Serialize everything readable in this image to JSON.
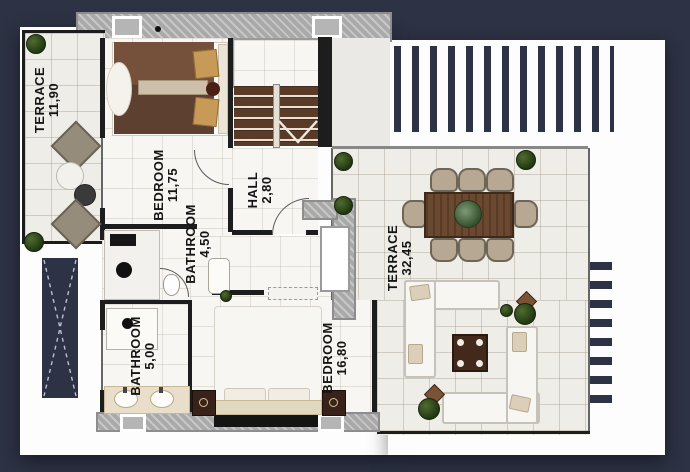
{
  "plan_title": "villa-upper-floor-plan",
  "palette": {
    "background": "#2d3244",
    "paper": "#fdfdfd",
    "wall_dark": "#1d1d1d",
    "wall_gray": "#a9a9a9",
    "stair_wood": "#5a3b28",
    "bed_wood": "#6d4a34",
    "plant_green": "#2f4a1b"
  },
  "rooms": [
    {
      "name": "TERRACE",
      "area": "11,90"
    },
    {
      "name": "BEDROOM",
      "area": "11,75"
    },
    {
      "name": "BATHROOM",
      "area": "4,50"
    },
    {
      "name": "HALL",
      "area": "2,80"
    },
    {
      "name": "TERRACE",
      "area": "32,45"
    },
    {
      "name": "BATHROOM",
      "area": "5,00"
    },
    {
      "name": "BEDROOM",
      "area": "16,80"
    }
  ]
}
